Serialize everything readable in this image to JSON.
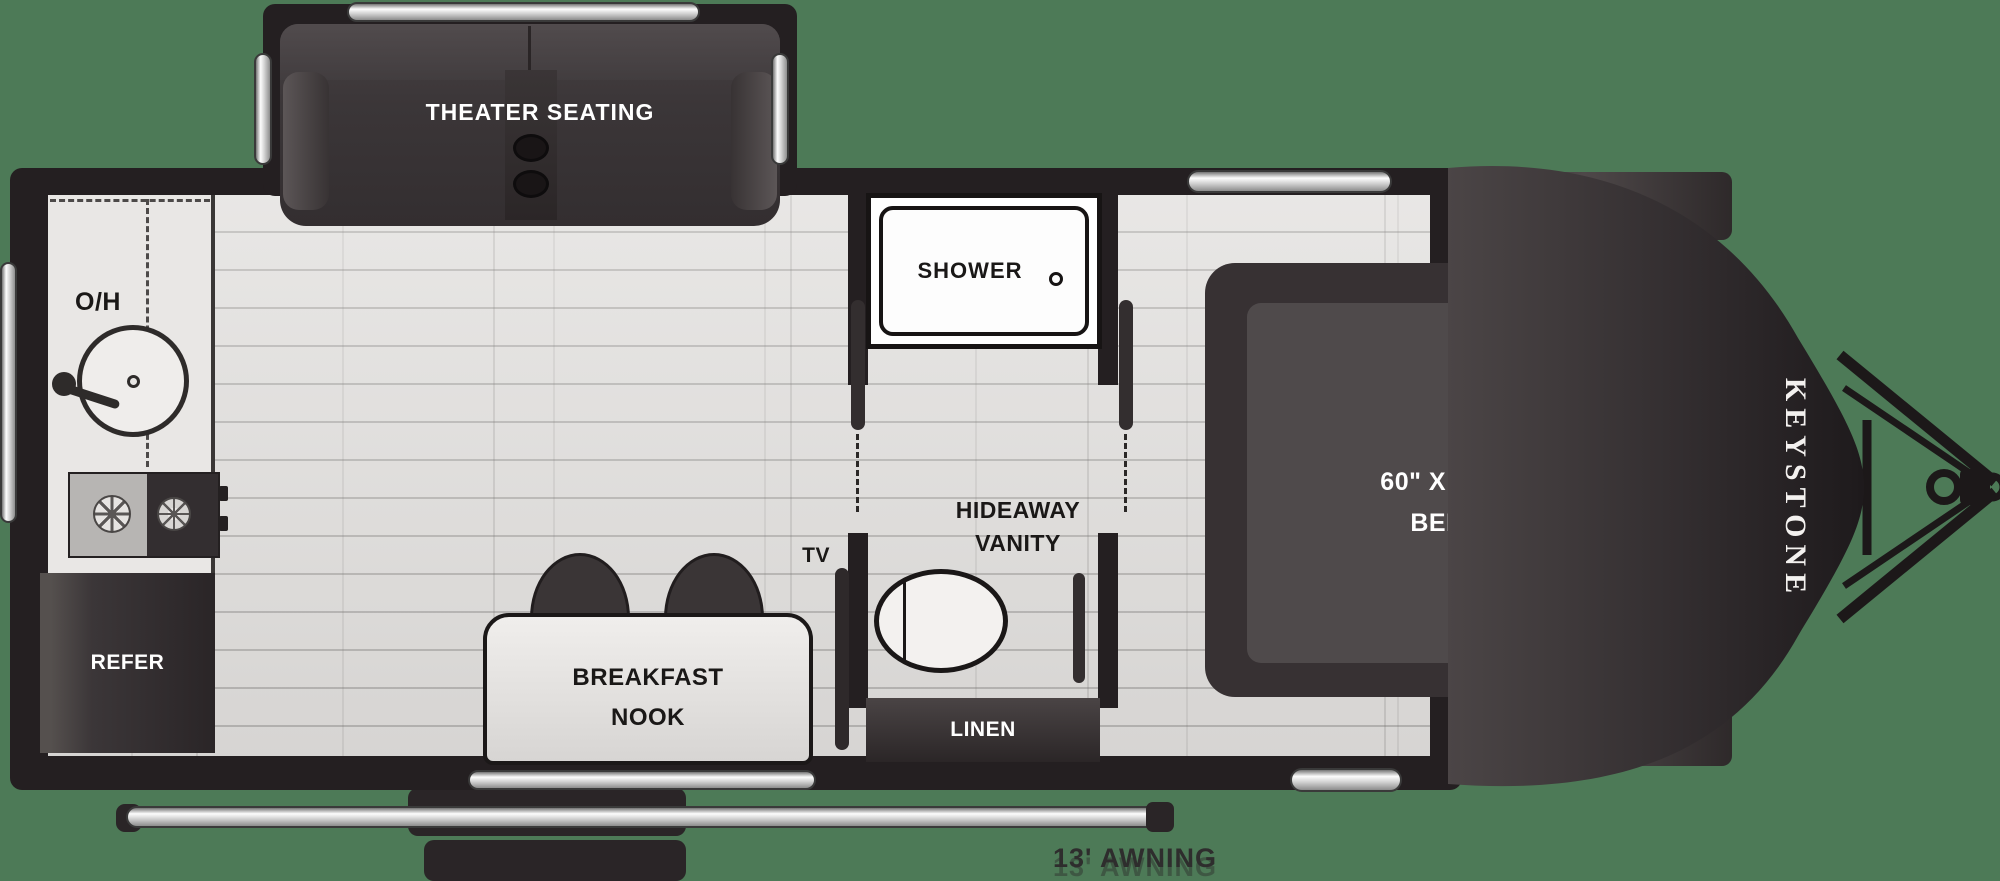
{
  "title": "Keystone travel trailer floor plan",
  "colors": {
    "background": "#4d7a57",
    "walls": "#241f21",
    "floor": "#e2e0de",
    "furniture_dark": "#383334",
    "counter_light": "#e9e7e5",
    "silver_trim": "#d2d2d2",
    "label_light": "#ffffff",
    "label_dark": "#1a1817"
  },
  "slideout": {
    "label": "THEATER SEATING"
  },
  "kitchen": {
    "overhead_label": "O/H",
    "refrigerator_label": "REFER"
  },
  "bathroom": {
    "shower_label": "SHOWER",
    "vanity_label_line1": "HIDEAWAY",
    "vanity_label_line2": "VANITY",
    "linen_label": "LINEN"
  },
  "living": {
    "tv_label": "TV",
    "nook_label_line1": "BREAKFAST",
    "nook_label_line2": "NOOK"
  },
  "bedroom": {
    "bed_size": "60\" X 74\"",
    "bed_label": "BED",
    "cubbies_top_label": "CUBBIES",
    "cubbies_bottom_label": "CUBBIES"
  },
  "exterior": {
    "brand": "KEYSTONE",
    "awning_label": "13' AWNING"
  }
}
